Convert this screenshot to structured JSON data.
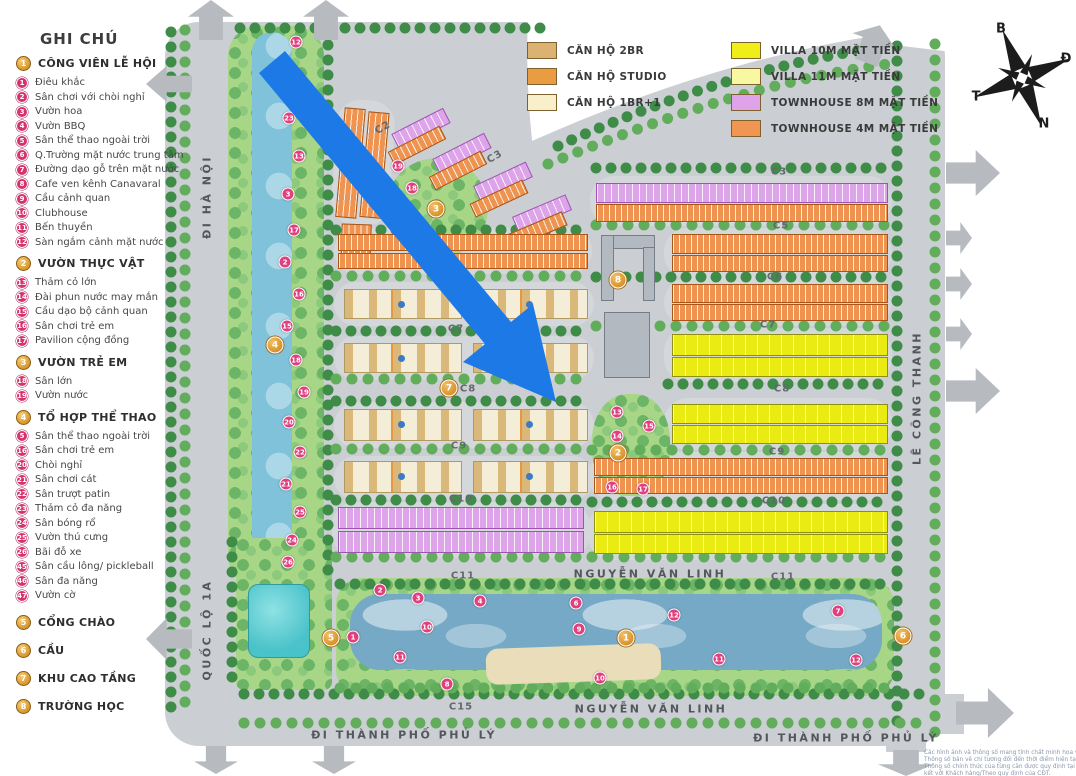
{
  "legend": {
    "title": "GHI CHÚ",
    "sections": [
      {
        "num": "1",
        "title": "CÔNG VIÊN LỄ HỘI",
        "items": [
          {
            "num": "1",
            "label": "Điêu khắc"
          },
          {
            "num": "2",
            "label": "Sân chơi với chòi nghỉ"
          },
          {
            "num": "3",
            "label": "Vườn hoa"
          },
          {
            "num": "4",
            "label": "Vườn BBQ"
          },
          {
            "num": "5",
            "label": "Sân thể thao ngoài trời"
          },
          {
            "num": "6",
            "label": "Q.Trường mặt nước trung tâm"
          },
          {
            "num": "7",
            "label": "Đường dạo gỗ trên mặt nước"
          },
          {
            "num": "8",
            "label": "Cafe ven kênh Canavaral"
          },
          {
            "num": "9",
            "label": "Cầu cảnh quan"
          },
          {
            "num": "10",
            "label": "Clubhouse"
          },
          {
            "num": "11",
            "label": "Bến thuyền"
          },
          {
            "num": "12",
            "label": "Sàn ngắm cảnh mặt nước"
          }
        ]
      },
      {
        "num": "2",
        "title": "VƯỜN THỰC VẬT",
        "items": [
          {
            "num": "13",
            "label": "Thảm cỏ lớn"
          },
          {
            "num": "14",
            "label": "Đài phun nước may mắn"
          },
          {
            "num": "15",
            "label": "Cầu dạo bộ cảnh quan"
          },
          {
            "num": "16",
            "label": "Sân chơi trẻ em"
          },
          {
            "num": "17",
            "label": "Pavilion cộng đồng"
          }
        ]
      },
      {
        "num": "3",
        "title": "VƯỜN TRẺ EM",
        "items": [
          {
            "num": "18",
            "label": "Sân lớn"
          },
          {
            "num": "19",
            "label": "Vườn nước"
          }
        ]
      },
      {
        "num": "4",
        "title": "TỔ HỢP THỂ THAO",
        "items": [
          {
            "num": "5",
            "label": "Sân thể thao ngoài trời"
          },
          {
            "num": "16",
            "label": "Sân chơi trẻ em"
          },
          {
            "num": "20",
            "label": "Chòi nghỉ"
          },
          {
            "num": "21",
            "label": "Sân chơi cát"
          },
          {
            "num": "22",
            "label": "Sân trượt patin"
          },
          {
            "num": "23",
            "label": "Thảm cỏ đa năng"
          },
          {
            "num": "24",
            "label": "Sân bóng rổ"
          },
          {
            "num": "25",
            "label": "Vườn thú cưng"
          },
          {
            "num": "26",
            "label": "Bãi đỗ xe"
          },
          {
            "num": "45",
            "label": "Sân cầu lông/ pickleball"
          },
          {
            "num": "46",
            "label": "Sân đa năng"
          },
          {
            "num": "47",
            "label": "Vườn cờ"
          }
        ]
      },
      {
        "num": "5",
        "title": "CỔNG CHÀO",
        "items": []
      },
      {
        "num": "6",
        "title": "CẦU",
        "items": []
      },
      {
        "num": "7",
        "title": "KHU CAO TẦNG",
        "items": []
      },
      {
        "num": "8",
        "title": "TRƯỜNG HỌC",
        "items": []
      }
    ]
  },
  "unit_legend": {
    "apartments": [
      {
        "label": "CĂN HỘ 2BR",
        "color": "#dcb273"
      },
      {
        "label": "CĂN HỘ STUDIO",
        "color": "#e99c42"
      },
      {
        "label": "CĂN HỘ 1BR+1",
        "color": "#f8f0cb"
      }
    ],
    "houses": [
      {
        "label": "VILLA 10M MẶT TIỀN",
        "color": "#f0ee18"
      },
      {
        "label": "VILLA 11M MẶT TIỀN",
        "color": "#f8f8a2"
      },
      {
        "label": "TOWNHOUSE 8M MẶT TIỀN",
        "color": "#dfa3ea"
      },
      {
        "label": "TOWNHOUSE 4M MẶT TIỀN",
        "color": "#f09552"
      }
    ]
  },
  "compass": {
    "north": "B",
    "east": "Đ",
    "west": "T",
    "south": "N"
  },
  "map": {
    "road_labels": [
      {
        "text": "ĐI HÀ NỘI",
        "x": 207,
        "y": 197,
        "vertical": true
      },
      {
        "text": "QUỐC LỘ 1A",
        "x": 207,
        "y": 630,
        "vertical": true
      },
      {
        "text": "LÊ CÔNG THANH",
        "x": 917,
        "y": 398,
        "vertical": true
      },
      {
        "text": "NGUYỄN VĂN LINH",
        "x": 650,
        "y": 574,
        "vertical": false
      },
      {
        "text": "NGUYỄN VĂN LINH",
        "x": 651,
        "y": 709,
        "vertical": false
      },
      {
        "text": "ĐI THÀNH PHỐ PHỦ LÝ",
        "x": 404,
        "y": 735,
        "vertical": false
      },
      {
        "text": "ĐI THÀNH PHỐ PHỦ LÝ",
        "x": 846,
        "y": 738,
        "vertical": false
      }
    ],
    "block_labels": [
      {
        "text": "C1",
        "x": 338,
        "y": 146,
        "r": 78
      },
      {
        "text": "C2",
        "x": 383,
        "y": 128,
        "r": -30
      },
      {
        "text": "C3",
        "x": 495,
        "y": 157,
        "r": -30
      },
      {
        "text": "C3",
        "x": 779,
        "y": 172,
        "r": 0
      },
      {
        "text": "C5",
        "x": 781,
        "y": 226,
        "r": 0
      },
      {
        "text": "C6",
        "x": 775,
        "y": 277,
        "r": 0
      },
      {
        "text": "C7",
        "x": 768,
        "y": 325,
        "r": 0
      },
      {
        "text": "C7",
        "x": 456,
        "y": 329,
        "r": 0
      },
      {
        "text": "C8",
        "x": 468,
        "y": 389,
        "r": 0
      },
      {
        "text": "C8",
        "x": 782,
        "y": 389,
        "r": 0
      },
      {
        "text": "C9",
        "x": 459,
        "y": 446,
        "r": 0
      },
      {
        "text": "C9",
        "x": 777,
        "y": 452,
        "r": 0
      },
      {
        "text": "C10",
        "x": 461,
        "y": 499,
        "r": 0
      },
      {
        "text": "C10",
        "x": 774,
        "y": 501,
        "r": 0
      },
      {
        "text": "C11",
        "x": 463,
        "y": 576,
        "r": 0
      },
      {
        "text": "C11",
        "x": 783,
        "y": 577,
        "r": 0
      },
      {
        "text": "C15",
        "x": 461,
        "y": 707,
        "r": 0
      }
    ],
    "gold_markers": [
      {
        "num": "1",
        "x": 626,
        "y": 638
      },
      {
        "num": "2",
        "x": 618,
        "y": 453
      },
      {
        "num": "3",
        "x": 436,
        "y": 209
      },
      {
        "num": "4",
        "x": 275,
        "y": 345
      },
      {
        "num": "5",
        "x": 331,
        "y": 638
      },
      {
        "num": "6",
        "x": 903,
        "y": 636
      },
      {
        "num": "7",
        "x": 449,
        "y": 388
      },
      {
        "num": "8",
        "x": 618,
        "y": 280
      }
    ],
    "pink_markers": [
      {
        "num": "12",
        "x": 296,
        "y": 42
      },
      {
        "num": "14",
        "x": 297,
        "y": 76
      },
      {
        "num": "23",
        "x": 289,
        "y": 118
      },
      {
        "num": "13",
        "x": 299,
        "y": 156
      },
      {
        "num": "3",
        "x": 288,
        "y": 194
      },
      {
        "num": "17",
        "x": 294,
        "y": 230
      },
      {
        "num": "2",
        "x": 285,
        "y": 262
      },
      {
        "num": "16",
        "x": 299,
        "y": 294
      },
      {
        "num": "15",
        "x": 287,
        "y": 326
      },
      {
        "num": "18",
        "x": 296,
        "y": 360
      },
      {
        "num": "19",
        "x": 304,
        "y": 392
      },
      {
        "num": "20",
        "x": 289,
        "y": 422
      },
      {
        "num": "22",
        "x": 300,
        "y": 452
      },
      {
        "num": "21",
        "x": 286,
        "y": 484
      },
      {
        "num": "25",
        "x": 300,
        "y": 512
      },
      {
        "num": "24",
        "x": 292,
        "y": 540
      },
      {
        "num": "26",
        "x": 288,
        "y": 562
      },
      {
        "num": "19",
        "x": 398,
        "y": 166
      },
      {
        "num": "18",
        "x": 412,
        "y": 188
      },
      {
        "num": "13",
        "x": 617,
        "y": 412
      },
      {
        "num": "15",
        "x": 649,
        "y": 426
      },
      {
        "num": "14",
        "x": 617,
        "y": 436
      },
      {
        "num": "16",
        "x": 612,
        "y": 487
      },
      {
        "num": "17",
        "x": 643,
        "y": 489
      },
      {
        "num": "2",
        "x": 380,
        "y": 590
      },
      {
        "num": "3",
        "x": 418,
        "y": 598
      },
      {
        "num": "4",
        "x": 480,
        "y": 601
      },
      {
        "num": "10",
        "x": 427,
        "y": 627
      },
      {
        "num": "1",
        "x": 353,
        "y": 637
      },
      {
        "num": "11",
        "x": 400,
        "y": 657
      },
      {
        "num": "8",
        "x": 447,
        "y": 684
      },
      {
        "num": "6",
        "x": 576,
        "y": 603
      },
      {
        "num": "9",
        "x": 579,
        "y": 629
      },
      {
        "num": "12",
        "x": 674,
        "y": 615
      },
      {
        "num": "10",
        "x": 600,
        "y": 678
      },
      {
        "num": "11",
        "x": 719,
        "y": 659
      },
      {
        "num": "7",
        "x": 838,
        "y": 611
      },
      {
        "num": "12",
        "x": 856,
        "y": 660
      }
    ]
  },
  "disclaimer": {
    "lines": [
      "Các hình ảnh và thông số mang tính chất minh họa và tham khảo.",
      "Thông số bản vẽ chỉ tương đối đến thời điểm hiện tại.",
      "Thông số chính thức của từng căn được quy định tại văn bản ký",
      "kết với Khách hàng/Theo quy định của CĐT."
    ]
  }
}
